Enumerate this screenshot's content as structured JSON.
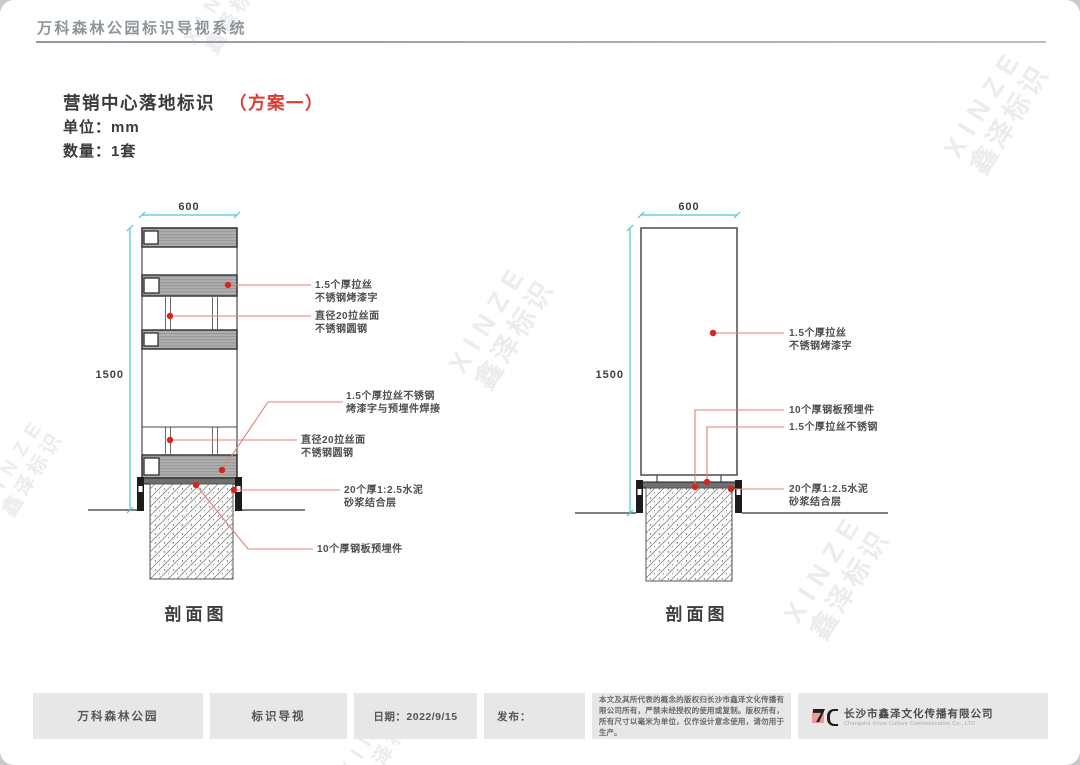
{
  "page": {
    "header_title": "万科森林公园标识导视系统"
  },
  "title_block": {
    "title": "营销中心落地标识",
    "scheme": "（方案一）",
    "unit": "单位：mm",
    "quantity": "数量：1套"
  },
  "watermark": {
    "latin": "XINZE",
    "cn": "鑫泽标识"
  },
  "diagrams": {
    "left": {
      "caption": "剖面图",
      "width_dim": "600",
      "height_dim": "1500",
      "callouts": [
        {
          "lines": [
            "1.5个厚拉丝",
            "不锈钢烤漆字"
          ]
        },
        {
          "lines": [
            "直径20拉丝面",
            "不锈钢圆钢"
          ]
        },
        {
          "lines": [
            "1.5个厚拉丝不锈钢",
            "烤漆字与预埋件焊接"
          ]
        },
        {
          "lines": [
            "直径20拉丝面",
            "不锈钢圆钢"
          ]
        },
        {
          "lines": [
            "20个厚1:2.5水泥",
            "砂浆结合层"
          ]
        },
        {
          "lines": [
            "10个厚钢板预埋件"
          ]
        }
      ]
    },
    "right": {
      "caption": "剖面图",
      "width_dim": "600",
      "height_dim": "1500",
      "callouts": [
        {
          "lines": [
            "1.5个厚拉丝",
            "不锈钢烤漆字"
          ]
        },
        {
          "lines": [
            "10个厚钢板预埋件"
          ]
        },
        {
          "lines": [
            "1.5个厚拉丝不锈钢"
          ]
        },
        {
          "lines": [
            "20个厚1:2.5水泥",
            "砂浆结合层"
          ]
        }
      ]
    }
  },
  "footer": {
    "project": "万科森林公园",
    "category": "标识导视",
    "date": "日期：2022/9/15",
    "release": "发布：",
    "disclaimer": "本文及其所代表的概念的版权归长沙市鑫泽文化传播有限公司所有，严禁未经授权的使用或复制。版权所有，所有尺寸以毫米为单位，仅作设计意念使用，请勿用于生产。",
    "company_cn": "长沙市鑫泽文化传播有限公司",
    "company_en": "Changsha Xinze Culture Communication Co., LTD"
  },
  "colors": {
    "accent_red": "#e03a30",
    "leader_red": "#e08078",
    "dot_red": "#d6251a",
    "dim_cyan": "#4ec3e0",
    "line_dark": "#3f3f3f",
    "footer_gray": "#e7e7e7"
  }
}
